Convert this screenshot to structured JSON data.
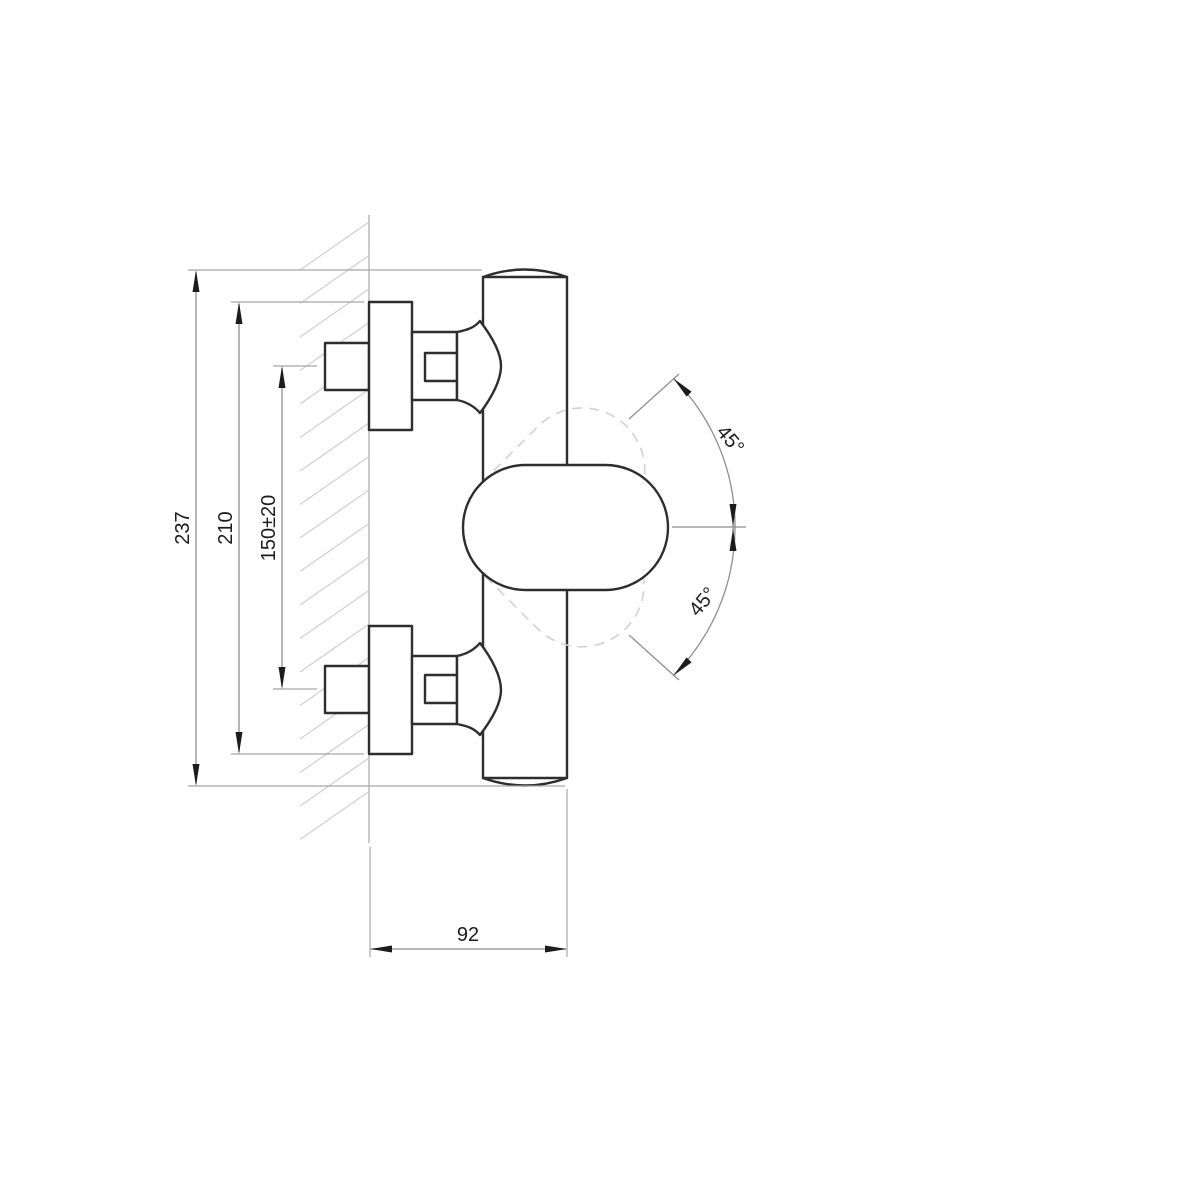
{
  "drawing": {
    "kind": "technical-dimension-drawing",
    "subject": "wall-mounted shower mixer tap, side view",
    "dimensions": {
      "height_total": "237",
      "height_body": "210",
      "inlet_spacing": "150±20",
      "depth": "92",
      "handle_swing_up": "45°",
      "handle_swing_down": "45°"
    },
    "colors": {
      "background": "#ffffff",
      "part_outline": "#2e2e2e",
      "dimension_lines": "#8f8f8f",
      "wall_hatching": "#d0d0d0",
      "ghost_dashed": "#d2d2d2",
      "text": "#1c1c1c"
    }
  }
}
